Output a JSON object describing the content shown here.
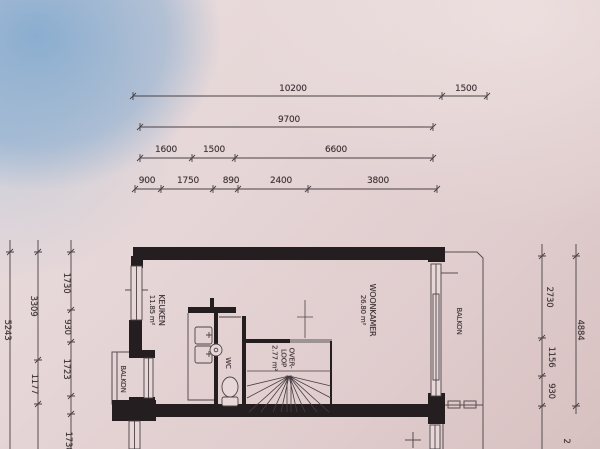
{
  "dimensions": {
    "top": [
      {
        "label": "10200"
      },
      {
        "label": "1500"
      },
      {
        "label": "9700"
      },
      {
        "label": "1600"
      },
      {
        "label": "1500"
      },
      {
        "label": "6600"
      },
      {
        "label": "900"
      },
      {
        "label": "1750"
      },
      {
        "label": "890"
      },
      {
        "label": "2400"
      },
      {
        "label": "3800"
      }
    ],
    "left": [
      {
        "label": "5243"
      },
      {
        "label": "3309"
      },
      {
        "label": "1177"
      },
      {
        "label": "1730"
      },
      {
        "label": "930"
      },
      {
        "label": "1723"
      },
      {
        "label": "1730"
      }
    ],
    "right": [
      {
        "label": "2730"
      },
      {
        "label": "4884"
      },
      {
        "label": "1156"
      },
      {
        "label": "930"
      },
      {
        "label": "2"
      }
    ]
  },
  "rooms": {
    "keuken": {
      "name": "KEUKEN",
      "area": "11.85 m²"
    },
    "woonkamer": {
      "name": "WOONKAMER",
      "area": "26.80 m²"
    },
    "overloop": {
      "line1": "OVER-",
      "line2": "LOOP",
      "area": "2.77 m²"
    },
    "wc": {
      "name": "WC"
    },
    "balkon_left": {
      "name": "BALKON"
    },
    "balkon_right": {
      "name": "BALKON"
    }
  },
  "colors": {
    "paper": "#e4d3d4",
    "blue_patch": "#8db1d2",
    "ink": "#41383b",
    "wall": "#241e20"
  }
}
